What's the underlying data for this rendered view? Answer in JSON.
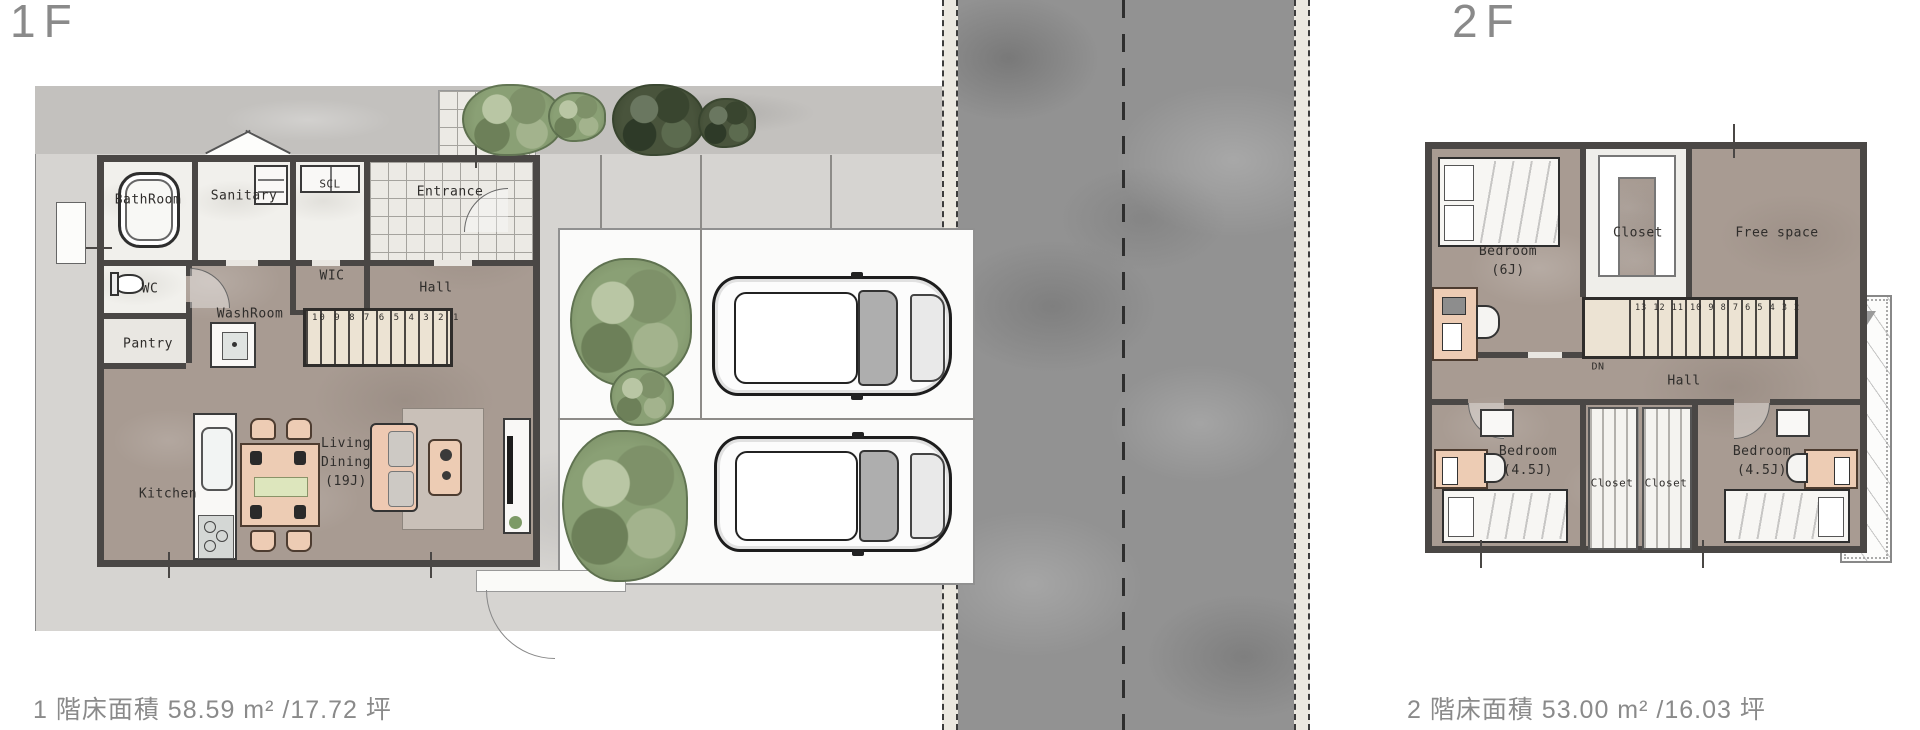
{
  "palette": {
    "wall": "#4a4745",
    "interior_floor": "#a89b92",
    "site_ground": "#d6d4d1",
    "road": "#929292",
    "sidewalk": "#ebe8e0",
    "wet_room": "#f1f0ec",
    "stair": "#ece3d3",
    "furniture_wood": "#edccb4",
    "tree_green": "#8aa075",
    "tree_dark": "#49543c",
    "label_gray": "#8a8a8a"
  },
  "f1": {
    "floor_label": "1F",
    "caption": "1 階床面積 58.59 m² /17.72 坪",
    "rooms": {
      "bathroom": "BathRoom",
      "sanitary": "Sanitary",
      "scl": "SCL",
      "entrance": "Entrance",
      "wc": "WC",
      "wic": "WIC",
      "hall": "Hall",
      "washroom": "WashRoom",
      "pantry": "Pantry",
      "kitchen": "Kitchen"
    },
    "living_dining": {
      "l1": "Living",
      "l2": "Dining",
      "l3": "(19J)"
    },
    "stairs": "10 9 8 7 6 5 4 3 2 1"
  },
  "f2": {
    "floor_label": "2F",
    "caption": "2 階床面積 53.00 m² /16.03 坪",
    "rooms": {
      "bedroom_main_l1": "Bedroom",
      "bedroom_main_l2": "(6J)",
      "closet_top": "Closet",
      "free_space": "Free space",
      "hall": "Hall",
      "bedroom_left_l1": "Bedroom",
      "bedroom_left_l2": "(4.5J)",
      "closet_left": "Closet",
      "closet_right": "Closet",
      "bedroom_right_l1": "Bedroom",
      "bedroom_right_l2": "(4.5J)",
      "down": "DN",
      "balcony_dim": "1.50"
    },
    "stairs": "13 12 11 10 9 8 7 6 5 4 3 2"
  }
}
